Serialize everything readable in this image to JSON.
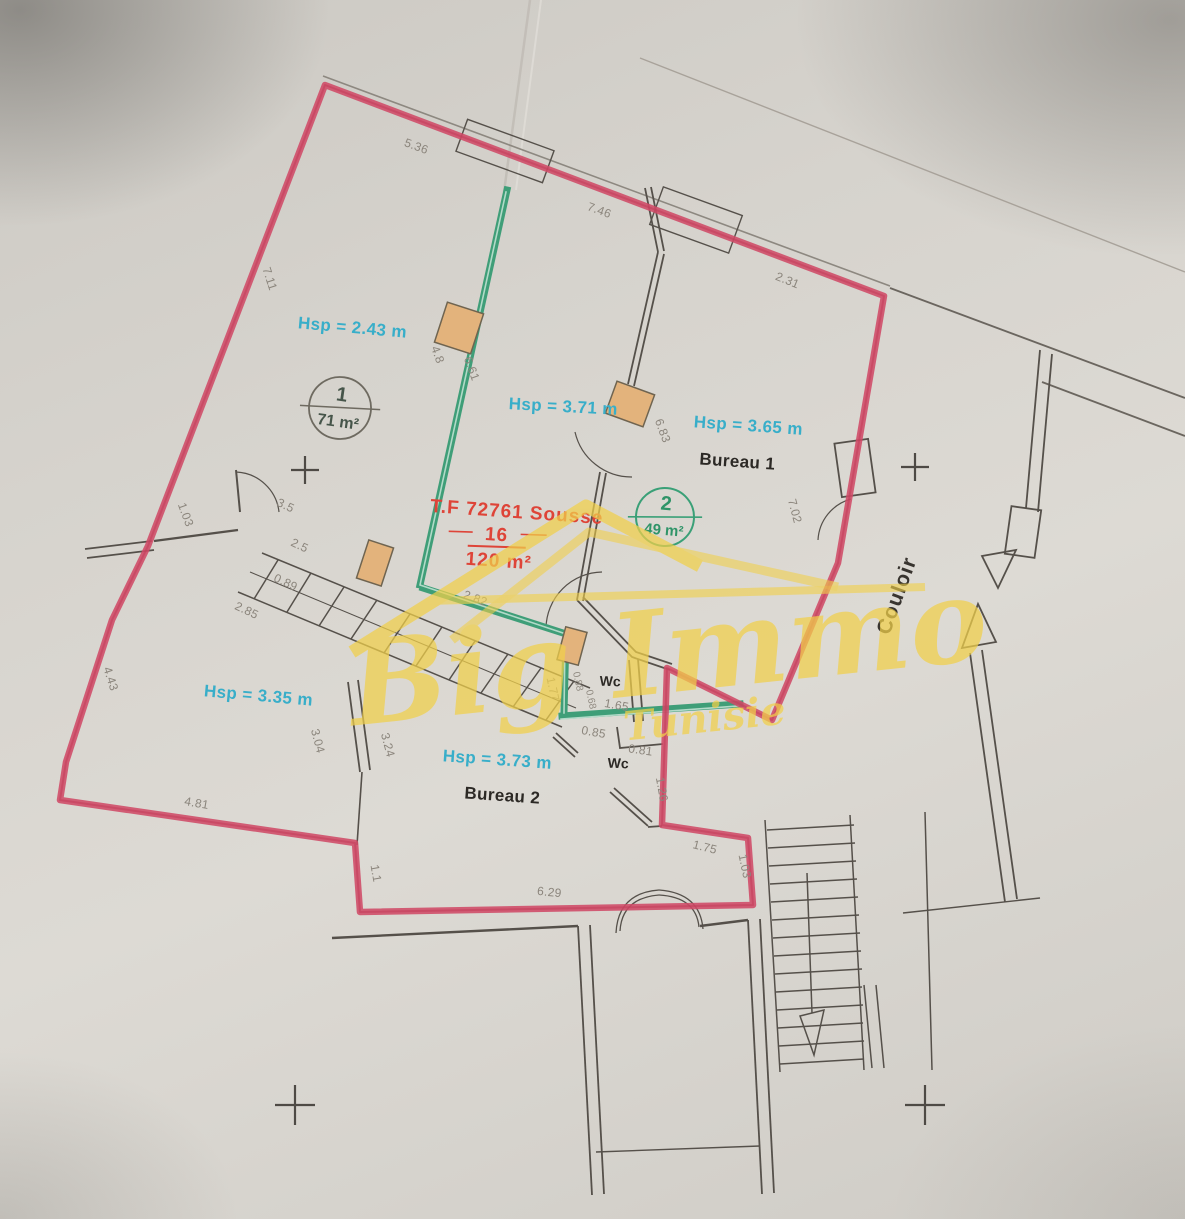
{
  "plan": {
    "title": {
      "tf": "T.F  72761  Sousse",
      "lot": "16",
      "total_area": "120 m²"
    },
    "labels": {
      "hsp_room1": "Hsp = 2.43 m",
      "hsp_room2": "Hsp = 3.71 m",
      "hsp_bureau1": "Hsp = 3.65 m",
      "hsp_left": "Hsp = 3.35 m",
      "hsp_bureau2": "Hsp = 3.73 m",
      "bureau1": "Bureau 1",
      "bureau2": "Bureau 2",
      "wc_top": "Wc",
      "wc_bottom": "Wc",
      "couloir": "Couloir",
      "room1_num": "1",
      "room1_area": "71 m²",
      "room2_num": "2",
      "room2_area": "49 m²"
    },
    "watermark": {
      "name": "Big Immo",
      "sub": "Tunisie"
    },
    "dims": [
      "5.36",
      "7.46",
      "2.31",
      "7.11",
      "4.8",
      "6.61",
      "6.83",
      "7.02",
      "1.03",
      "3.5",
      "2.5",
      "0.89",
      "2.85",
      "2.82",
      "4.43",
      "3.04",
      "3.24",
      "1.77",
      "0.88",
      "0.68",
      "1.65",
      "0.85",
      "0.81",
      "1.26",
      "4.81",
      "1.1",
      "6.29",
      "1.75",
      "1.03"
    ],
    "colors": {
      "boundary": "#cf4a66",
      "partition_green": "#3f9e78",
      "height_text": "#38aec9",
      "title_red": "#de4438",
      "watermark_gold": "#f1d04a",
      "wall": "#55504a",
      "dimension_text": "#8b857c",
      "column_fill": "#e3b37c"
    }
  }
}
